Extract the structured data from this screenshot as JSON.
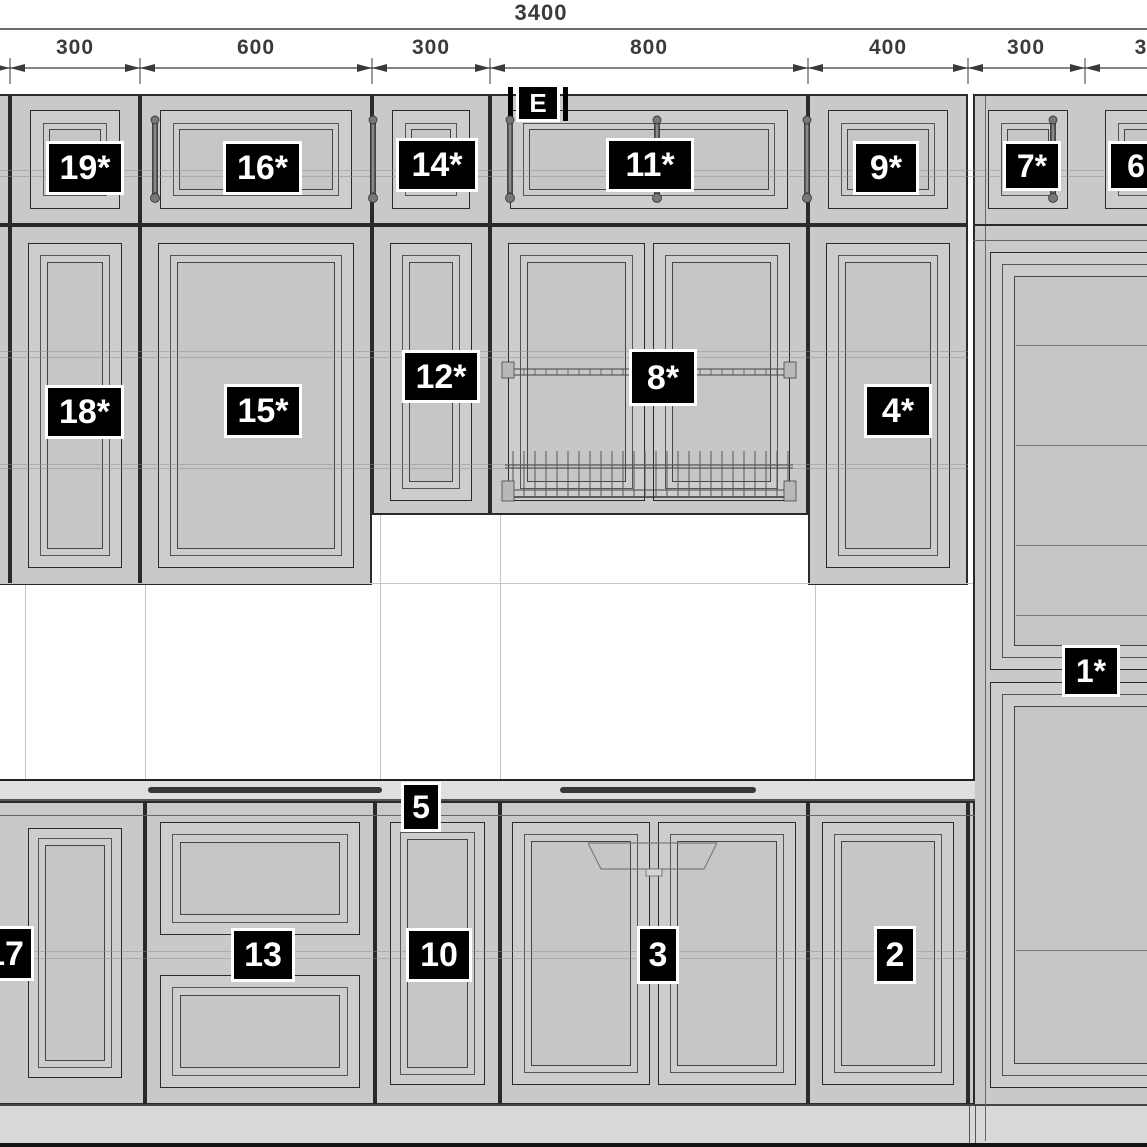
{
  "drawing": {
    "type": "kitchen cabinet elevation drawing",
    "elevation_label": "E"
  },
  "colors": {
    "background": "#ffffff",
    "cabinet_fill": "#c9c9c9",
    "door_fill": "#cdcdcd",
    "panel_fill": "#c6c6c6",
    "counter_fill": "#dfdfdf",
    "plinth_fill": "#d9d9d9",
    "outline_dark": "#2a2a2a",
    "outline_mid": "#555555",
    "badge_bg": "#000000",
    "badge_text": "#ffffff",
    "dim_text": "#3b3b3b"
  },
  "dimensions": {
    "overall": {
      "label": "3400",
      "cx": 541,
      "y": 0,
      "fs": 22,
      "line_y": 29
    },
    "segments_y": 36,
    "seg_fs": 21,
    "dim_line_y": 68,
    "ticks": [
      10,
      140,
      372,
      490,
      808,
      968,
      1085
    ],
    "segments": [
      {
        "label": "300",
        "cx": 75
      },
      {
        "label": "600",
        "cx": 256
      },
      {
        "label": "300",
        "cx": 431
      },
      {
        "label": "800",
        "cx": 649
      },
      {
        "label": "400",
        "cx": 888
      },
      {
        "label": "300",
        "cx": 1026
      },
      {
        "label": "3",
        "cx": 1141
      }
    ]
  },
  "badges": [
    {
      "name": "label-elevation-e",
      "label": "E",
      "x": 516,
      "y": 84,
      "w": 44,
      "h": 38,
      "fs": 26
    },
    {
      "name": "label-19",
      "label": "19*",
      "x": 46,
      "y": 141,
      "w": 78,
      "h": 54,
      "fs": 34
    },
    {
      "name": "label-16",
      "label": "16*",
      "x": 223,
      "y": 141,
      "w": 79,
      "h": 54,
      "fs": 34
    },
    {
      "name": "label-14",
      "label": "14*",
      "x": 396,
      "y": 138,
      "w": 82,
      "h": 54,
      "fs": 34
    },
    {
      "name": "label-11",
      "label": "11*",
      "x": 606,
      "y": 138,
      "w": 88,
      "h": 54,
      "fs": 34
    },
    {
      "name": "label-9",
      "label": "9*",
      "x": 853,
      "y": 141,
      "w": 66,
      "h": 54,
      "fs": 34
    },
    {
      "name": "label-7",
      "label": "7*",
      "x": 1003,
      "y": 141,
      "w": 58,
      "h": 50,
      "fs": 32
    },
    {
      "name": "label-6",
      "label": "6",
      "x": 1108,
      "y": 141,
      "w": 56,
      "h": 50,
      "fs": 32
    },
    {
      "name": "label-18",
      "label": "18*",
      "x": 45,
      "y": 385,
      "w": 79,
      "h": 54,
      "fs": 34
    },
    {
      "name": "label-15",
      "label": "15*",
      "x": 224,
      "y": 384,
      "w": 78,
      "h": 54,
      "fs": 34
    },
    {
      "name": "label-12",
      "label": "12*",
      "x": 402,
      "y": 350,
      "w": 78,
      "h": 53,
      "fs": 34
    },
    {
      "name": "label-8",
      "label": "8*",
      "x": 629,
      "y": 349,
      "w": 68,
      "h": 57,
      "fs": 34
    },
    {
      "name": "label-4",
      "label": "4*",
      "x": 864,
      "y": 384,
      "w": 68,
      "h": 54,
      "fs": 34
    },
    {
      "name": "label-1",
      "label": "1*",
      "x": 1062,
      "y": 645,
      "w": 58,
      "h": 52,
      "fs": 32
    },
    {
      "name": "label-5",
      "label": "5",
      "x": 401,
      "y": 782,
      "w": 40,
      "h": 50,
      "fs": 32
    },
    {
      "name": "label-17",
      "label": "17",
      "x": -24,
      "y": 926,
      "w": 58,
      "h": 55,
      "fs": 34
    },
    {
      "name": "label-13",
      "label": "13",
      "x": 231,
      "y": 928,
      "w": 64,
      "h": 54,
      "fs": 34
    },
    {
      "name": "label-10",
      "label": "10",
      "x": 406,
      "y": 928,
      "w": 66,
      "h": 54,
      "fs": 34
    },
    {
      "name": "label-3",
      "label": "3",
      "x": 637,
      "y": 926,
      "w": 42,
      "h": 58,
      "fs": 34
    },
    {
      "name": "label-2",
      "label": "2",
      "x": 874,
      "y": 926,
      "w": 42,
      "h": 58,
      "fs": 34
    }
  ],
  "styles": {
    "carcass": {
      "f": "#c9c9c9",
      "b": "2px solid #2a2a2a"
    },
    "door": {
      "f": "#cdcdcd",
      "b": "1.5px solid #2a2a2a"
    },
    "bevel": {
      "f": "transparent",
      "b": "1px solid #555"
    },
    "panel": {
      "f": "#c6c6c6",
      "b": "1px solid #444"
    },
    "counter": {
      "f": "#dfdfdf",
      "b": "none"
    },
    "plinth": {
      "f": "#d9d9d9",
      "b": "none"
    },
    "floor": {
      "f": "#141414",
      "b": "none"
    }
  },
  "boxes": [
    [
      "top-left-partial-cabinet",
      "carcass",
      -30,
      94,
      40,
      131
    ],
    [
      "cabinet-19-carcass",
      "carcass",
      10,
      94,
      130,
      131
    ],
    [
      "cabinet-19-door",
      "door",
      30,
      110,
      90,
      99
    ],
    [
      "cabinet-19-bevel",
      "bevel",
      43,
      123,
      64,
      73
    ],
    [
      "cabinet-19-panel",
      "panel",
      49,
      129,
      52,
      61
    ],
    [
      "cabinet-16-carcass",
      "carcass",
      140,
      94,
      232,
      131
    ],
    [
      "cabinet-16-door",
      "door",
      160,
      110,
      192,
      99
    ],
    [
      "cabinet-16-bevel",
      "bevel",
      173,
      123,
      166,
      73
    ],
    [
      "cabinet-16-panel",
      "panel",
      179,
      129,
      154,
      61
    ],
    [
      "cabinet-14-carcass",
      "carcass",
      372,
      94,
      118,
      131
    ],
    [
      "cabinet-14-door",
      "door",
      392,
      110,
      78,
      99
    ],
    [
      "cabinet-14-bevel",
      "bevel",
      405,
      123,
      52,
      73
    ],
    [
      "cabinet-14-panel",
      "panel",
      411,
      129,
      40,
      61
    ],
    [
      "cabinet-11-carcass",
      "carcass",
      490,
      94,
      318,
      131
    ],
    [
      "cabinet-11-door",
      "door",
      510,
      110,
      278,
      99
    ],
    [
      "cabinet-11-bevel",
      "bevel",
      523,
      123,
      252,
      73
    ],
    [
      "cabinet-11-panel",
      "panel",
      529,
      129,
      240,
      61
    ],
    [
      "cabinet-9-carcass",
      "carcass",
      808,
      94,
      160,
      131
    ],
    [
      "cabinet-9-door",
      "door",
      828,
      110,
      120,
      99
    ],
    [
      "cabinet-9-bevel",
      "bevel",
      841,
      123,
      94,
      73
    ],
    [
      "cabinet-9-panel",
      "panel",
      847,
      129,
      82,
      61
    ],
    [
      "tall-unit-carcass",
      "carcass",
      973,
      94,
      180,
      1049
    ],
    [
      "cabinet-7-door",
      "door",
      988,
      110,
      80,
      99
    ],
    [
      "cabinet-7-bevel",
      "bevel",
      1001,
      123,
      54,
      73
    ],
    [
      "cabinet-7-panel",
      "panel",
      1007,
      129,
      42,
      61
    ],
    [
      "cabinet-6-door",
      "door",
      1105,
      110,
      68,
      99
    ],
    [
      "cabinet-6-bevel",
      "bevel",
      1118,
      123,
      42,
      73
    ],
    [
      "cabinet-6-panel",
      "panel",
      1124,
      129,
      30,
      61
    ],
    [
      "mid-left-partial-cabinet",
      "carcass",
      -30,
      225,
      40,
      360
    ],
    [
      "cabinet-18-carcass",
      "carcass",
      10,
      225,
      130,
      360
    ],
    [
      "cabinet-18-door",
      "door",
      28,
      243,
      94,
      325
    ],
    [
      "cabinet-18-bevel",
      "bevel",
      40,
      255,
      70,
      301
    ],
    [
      "cabinet-18-panel",
      "panel",
      47,
      262,
      56,
      287
    ],
    [
      "cabinet-15-carcass",
      "carcass",
      140,
      225,
      232,
      360
    ],
    [
      "cabinet-15-door",
      "door",
      158,
      243,
      196,
      325
    ],
    [
      "cabinet-15-bevel",
      "bevel",
      170,
      255,
      172,
      301
    ],
    [
      "cabinet-15-panel",
      "panel",
      177,
      262,
      158,
      287
    ],
    [
      "cabinet-12-carcass",
      "carcass",
      372,
      225,
      118,
      290
    ],
    [
      "cabinet-12-door",
      "door",
      390,
      243,
      82,
      258
    ],
    [
      "cabinet-12-bevel",
      "bevel",
      402,
      255,
      58,
      234
    ],
    [
      "cabinet-12-panel",
      "panel",
      409,
      262,
      44,
      220
    ],
    [
      "cabinet-8-carcass",
      "carcass",
      490,
      225,
      318,
      290
    ],
    [
      "cabinet-8-door-left",
      "door",
      508,
      243,
      137,
      258
    ],
    [
      "cabinet-8-bevel-left",
      "bevel",
      520,
      255,
      113,
      234
    ],
    [
      "cabinet-8-panel-left",
      "panel",
      527,
      262,
      99,
      220
    ],
    [
      "cabinet-8-door-right",
      "door",
      653,
      243,
      137,
      258
    ],
    [
      "cabinet-8-bevel-right",
      "bevel",
      665,
      255,
      113,
      234
    ],
    [
      "cabinet-8-panel-right",
      "panel",
      672,
      262,
      99,
      220
    ],
    [
      "cabinet-4-carcass",
      "carcass",
      808,
      225,
      160,
      360
    ],
    [
      "cabinet-4-door",
      "door",
      826,
      243,
      124,
      325
    ],
    [
      "cabinet-4-bevel",
      "bevel",
      838,
      255,
      100,
      301
    ],
    [
      "cabinet-4-panel",
      "panel",
      845,
      262,
      86,
      287
    ],
    [
      "tall-unit-upper-door",
      "door",
      990,
      252,
      170,
      418
    ],
    [
      "tall-unit-upper-bevel",
      "bevel",
      1002,
      264,
      146,
      394
    ],
    [
      "tall-unit-upper-panel",
      "panel",
      1014,
      276,
      140,
      370
    ],
    [
      "tall-unit-lower-door",
      "door",
      990,
      682,
      170,
      406
    ],
    [
      "tall-unit-lower-bevel",
      "bevel",
      1002,
      694,
      146,
      382
    ],
    [
      "tall-unit-lower-panel",
      "panel",
      1014,
      706,
      140,
      358
    ],
    [
      "countertop-band",
      "counter",
      0,
      781,
      975,
      20
    ],
    [
      "base-17-carcass",
      "carcass",
      -30,
      801,
      175,
      304
    ],
    [
      "cabinet-17-door",
      "door",
      28,
      828,
      94,
      250
    ],
    [
      "cabinet-17-bevel",
      "bevel",
      38,
      838,
      74,
      230
    ],
    [
      "cabinet-17-panel",
      "panel",
      45,
      845,
      60,
      216
    ],
    [
      "base-13-carcass",
      "carcass",
      145,
      801,
      230,
      304
    ],
    [
      "cabinet-13-drawer-top",
      "door",
      160,
      822,
      200,
      113
    ],
    [
      "cabinet-13-drawer-top-bevel",
      "bevel",
      172,
      834,
      176,
      89
    ],
    [
      "cabinet-13-drawer-top-panel",
      "panel",
      180,
      842,
      160,
      73
    ],
    [
      "cabinet-13-drawer-bottom",
      "door",
      160,
      975,
      200,
      113
    ],
    [
      "cabinet-13-drawer-bottom-bevel",
      "bevel",
      172,
      987,
      176,
      89
    ],
    [
      "cabinet-13-drawer-bottom-panel",
      "panel",
      180,
      995,
      160,
      73
    ],
    [
      "base-10-carcass",
      "carcass",
      375,
      801,
      125,
      304
    ],
    [
      "cabinet-10-door",
      "door",
      390,
      822,
      95,
      263
    ],
    [
      "cabinet-10-bevel",
      "bevel",
      400,
      832,
      75,
      243
    ],
    [
      "cabinet-10-panel",
      "panel",
      407,
      839,
      61,
      229
    ],
    [
      "base-3-carcass",
      "carcass",
      500,
      801,
      308,
      304
    ],
    [
      "cabinet-3-door-left",
      "door",
      512,
      822,
      138,
      263
    ],
    [
      "cabinet-3-bevel-left",
      "bevel",
      524,
      834,
      114,
      239
    ],
    [
      "cabinet-3-panel-left",
      "panel",
      531,
      841,
      100,
      225
    ],
    [
      "cabinet-3-door-right",
      "door",
      658,
      822,
      138,
      263
    ],
    [
      "cabinet-3-bevel-right",
      "bevel",
      670,
      834,
      114,
      239
    ],
    [
      "cabinet-3-panel-right",
      "panel",
      677,
      841,
      100,
      225
    ],
    [
      "base-2-carcass",
      "carcass",
      808,
      801,
      160,
      304
    ],
    [
      "cabinet-2-door",
      "door",
      822,
      822,
      132,
      263
    ],
    [
      "cabinet-2-bevel",
      "bevel",
      834,
      834,
      108,
      239
    ],
    [
      "cabinet-2-panel",
      "panel",
      841,
      841,
      94,
      225
    ],
    [
      "base-filler-panel",
      "carcass",
      968,
      801,
      7,
      304
    ],
    [
      "plinth",
      "plinth",
      0,
      1105,
      1150,
      38
    ],
    [
      "floor-line",
      "floor",
      0,
      1143,
      1150,
      4
    ]
  ],
  "lines": [
    [
      "counter-top-edge",
      "#222",
      0,
      779,
      975,
      2
    ],
    [
      "counter-bottom-edge",
      "#555",
      0,
      799,
      975,
      2
    ],
    [
      "base-top-rail",
      "#666",
      0,
      815,
      975,
      1
    ],
    [
      "plinth-top-edge",
      "#444",
      0,
      1104,
      1150,
      2
    ],
    [
      "plinth-joint-left",
      "#555",
      969,
      1106,
      1,
      37
    ],
    [
      "plinth-joint-right",
      "#555",
      975,
      1106,
      1,
      37
    ],
    [
      "tall-unit-stile",
      "#666",
      985,
      96,
      1,
      1045
    ],
    [
      "tall-unit-row-divider",
      "#2a2a2a",
      973,
      224,
      180,
      2
    ],
    [
      "tall-unit-row-divider-2",
      "#666",
      973,
      240,
      180,
      1
    ],
    [
      "tall-unit-shelf-1",
      "#777",
      1016,
      345,
      131,
      1
    ],
    [
      "tall-unit-shelf-2",
      "#777",
      1016,
      445,
      131,
      1
    ],
    [
      "tall-unit-shelf-3",
      "#777",
      1016,
      545,
      131,
      1
    ],
    [
      "tall-unit-shelf-4",
      "#777",
      1016,
      615,
      131,
      1
    ],
    [
      "tall-unit-shelf-5",
      "#777",
      1016,
      950,
      131,
      1
    ],
    [
      "counter-strip-left",
      "#383838",
      148,
      787,
      234,
      6
    ],
    [
      "counter-strip-right",
      "#383838",
      560,
      787,
      196,
      6
    ],
    [
      "wall-grid-v1",
      "#c6c6c6",
      25,
      585,
      1,
      194
    ],
    [
      "wall-grid-v2",
      "#c6c6c6",
      145,
      585,
      1,
      194
    ],
    [
      "wall-grid-v3",
      "#c6c6c6",
      380,
      515,
      1,
      264
    ],
    [
      "wall-grid-v4",
      "#c6c6c6",
      500,
      515,
      1,
      264
    ],
    [
      "wall-grid-v5",
      "#c6c6c6",
      815,
      585,
      1,
      194
    ],
    [
      "wall-grid-h",
      "#c6c6c6",
      0,
      583,
      973,
      1
    ],
    [
      "e-badge-bar-left",
      "#000",
      508,
      87,
      5,
      34
    ],
    [
      "e-badge-bar-right",
      "#000",
      563,
      87,
      5,
      34
    ]
  ],
  "overlay_lines": [
    [
      "shelf-line-top-row-a",
      0,
      170,
      1147,
      1
    ],
    [
      "shelf-line-top-row-b",
      0,
      176,
      1147,
      1
    ],
    [
      "shelf-line-mid-a",
      0,
      351,
      968,
      1
    ],
    [
      "shelf-line-mid-b",
      0,
      357,
      968,
      1
    ],
    [
      "shelf-line-mid-c",
      0,
      464,
      968,
      1
    ],
    [
      "shelf-line-mid-d",
      0,
      468,
      968,
      1
    ],
    [
      "shelf-line-base-a",
      0,
      951,
      968,
      1
    ],
    [
      "shelf-line-base-b",
      0,
      958,
      968,
      1
    ]
  ],
  "svg": {
    "strut_xs": [
      155,
      373,
      510,
      657,
      807,
      1053
    ],
    "strut_y1": 116,
    "strut_y2": 200,
    "rack": {
      "x1": 505,
      "x2": 793,
      "rail_y1": 369,
      "rail_y2": 375,
      "low_y1": 465,
      "low_y2": 468,
      "low_y3": 490,
      "low_y4": 497,
      "tine_top": 451,
      "tine_step": 11
    },
    "sink": {
      "x1": 588,
      "x2": 717,
      "y_top": 843,
      "y_bot": 869,
      "inset": 13,
      "tab_x": 646,
      "tab_w": 16,
      "tab_h": 7
    }
  }
}
